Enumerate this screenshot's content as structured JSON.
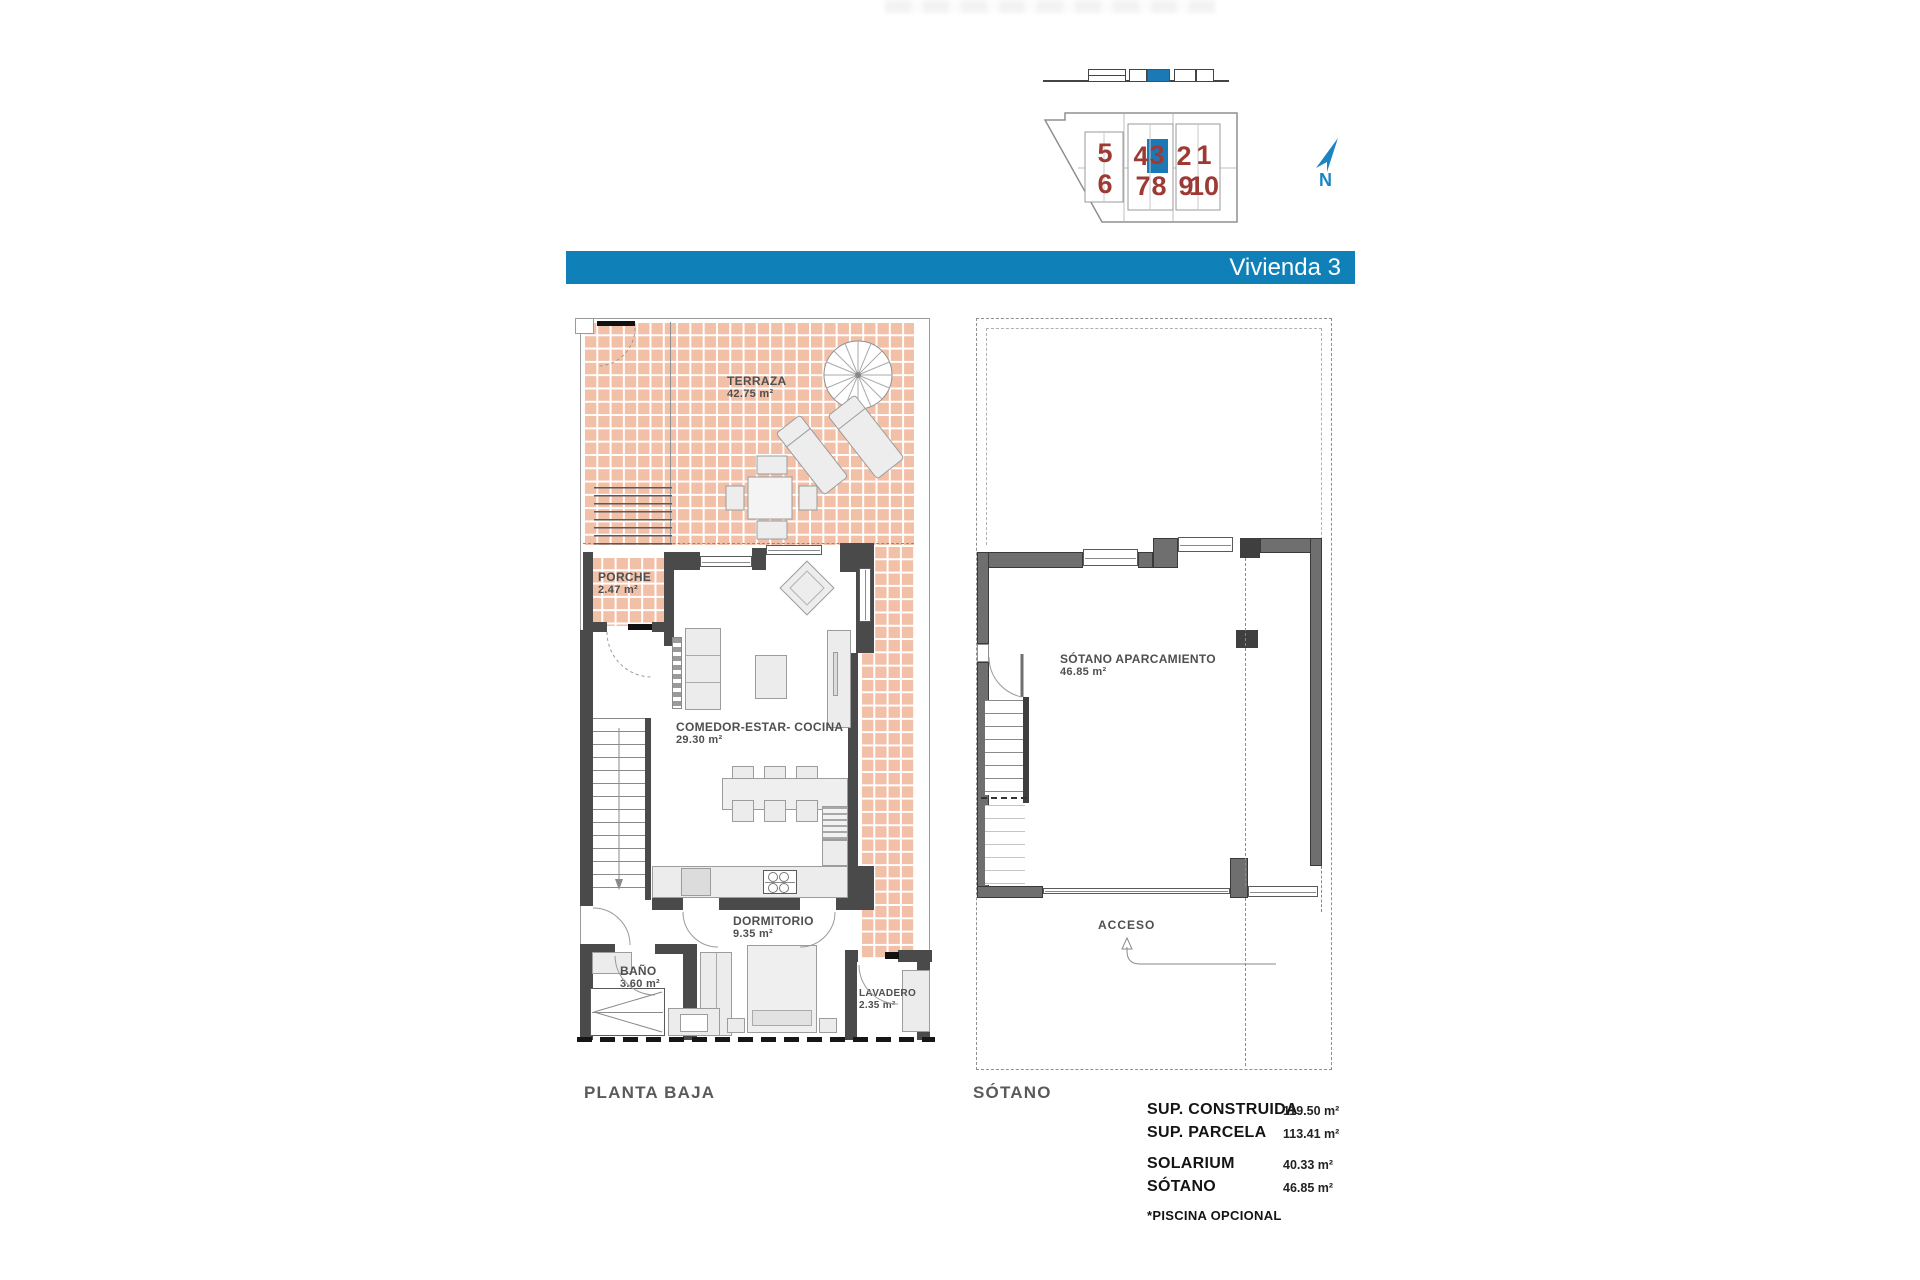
{
  "banner": {
    "title": "Vivienda 3",
    "color": "#0f81b8",
    "text_color": "#ffffff"
  },
  "site_plan": {
    "numbers_row1": [
      "5",
      "4",
      "3",
      "2",
      "1"
    ],
    "numbers_row2": [
      "6",
      "7",
      "8",
      "9",
      "10"
    ],
    "highlighted_unit": "3",
    "north_label": "N",
    "number_color": "#9d3a34",
    "highlight_color": "#1b7ab6"
  },
  "planta_baja": {
    "floor_label": "PLANTA BAJA",
    "terraza_label": "TERRAZA",
    "terraza_area": "42.75 m²",
    "porche_label": "PORCHE",
    "porche_area": "2.47 m²",
    "salon_label": "COMEDOR-ESTAR- COCINA",
    "salon_area": "29.30 m²",
    "dormitorio_label": "DORMITORIO",
    "dormitorio_area": "9.35 m²",
    "bano_label": "BAÑO",
    "bano_area": "3.60 m²",
    "lavadero_label": "LAVADERO",
    "lavadero_area": "2.35 m²"
  },
  "sotano": {
    "floor_label": "SÓTANO",
    "aparcamiento_label": "SÓTANO APARCAMIENTO",
    "aparcamiento_area": "46.85 m²",
    "acceso_label": "ACCESO"
  },
  "summary": {
    "rows": [
      {
        "label": "SUP. CONSTRUIDA",
        "value": "119.50 m²"
      },
      {
        "label": "SUP. PARCELA",
        "value": "113.41 m²"
      },
      {
        "label": "SOLARIUM",
        "value": "40.33 m²"
      },
      {
        "label": "SÓTANO",
        "value": "46.85 m²"
      }
    ],
    "note": "*PISCINA OPCIONAL"
  },
  "colors": {
    "tile": "#f2bfa7",
    "wall_dark": "#4a4a4a",
    "wall_mid": "#6f6f6f",
    "accent_blue": "#0f81b8",
    "number_red": "#9d3a34"
  }
}
